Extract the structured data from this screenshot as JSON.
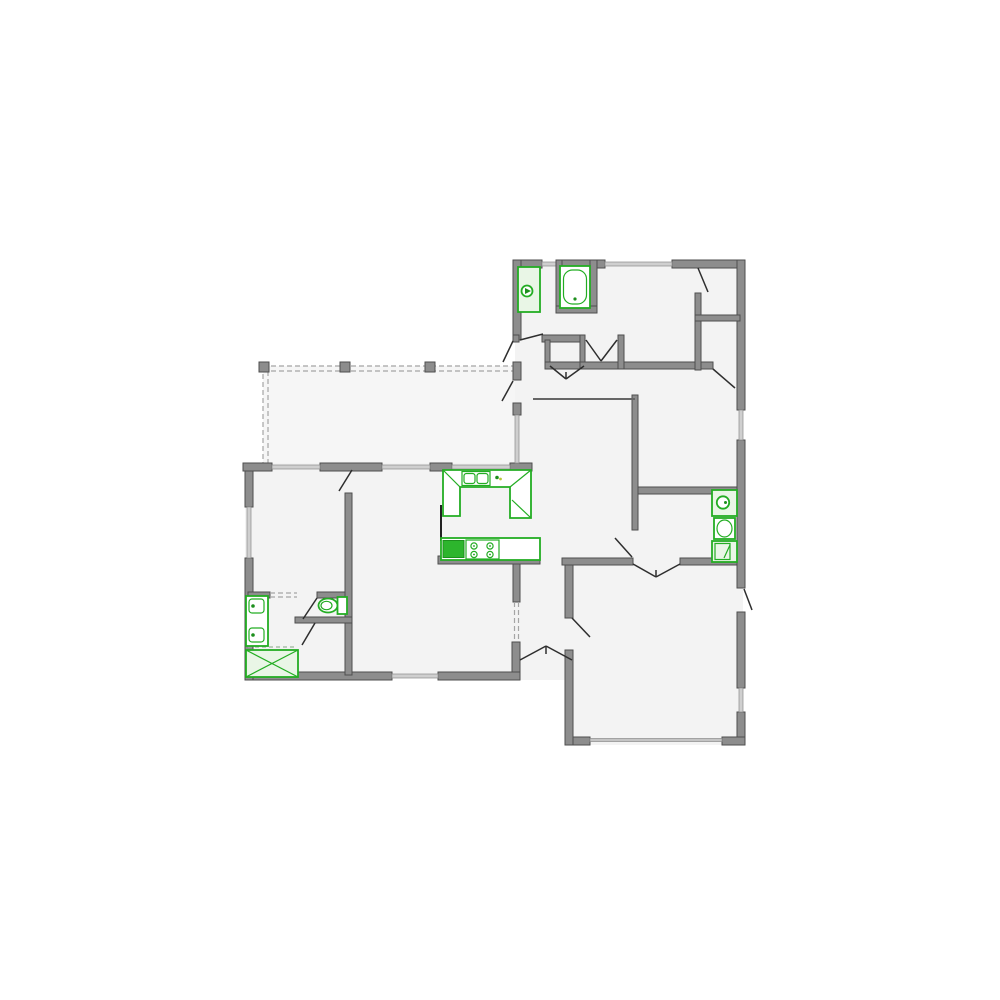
{
  "diagram": {
    "type": "floor-plan",
    "description": "Single-story residential floor plan, top-down architectural line drawing with gray walls and green plumbing/kitchen fixtures",
    "text_labels": []
  },
  "colors": {
    "background": "#ffffff",
    "floor": "#f3f3f3",
    "patio_floor": "#f6f6f6",
    "wall": "#8d8d8d",
    "wall_outline": "#4e4e4e",
    "window": "#cfcfcf",
    "fixture_green": "#23ad23",
    "fixture_fill_pale": "#e9f6e6",
    "fixture_fill_solid": "#2db52d",
    "door_leaf": "#2e2e2e",
    "dashed_line": "#a5a5a5"
  },
  "fixtures": [
    {
      "name": "bathtub",
      "area": "top-bathroom"
    },
    {
      "name": "toilet-stall",
      "area": "top-bathroom"
    },
    {
      "name": "kitchen-u-counter",
      "area": "kitchen"
    },
    {
      "name": "double-sink",
      "area": "kitchen"
    },
    {
      "name": "refrigerator",
      "area": "kitchen"
    },
    {
      "name": "range-cooktop",
      "area": "kitchen"
    },
    {
      "name": "toilet",
      "area": "right-bathroom"
    },
    {
      "name": "lavatory-sink",
      "area": "right-bathroom"
    },
    {
      "name": "washer-cabinet",
      "area": "right-bathroom"
    },
    {
      "name": "double-vanity",
      "area": "left-bathroom"
    },
    {
      "name": "toilet",
      "area": "left-bathroom"
    },
    {
      "name": "shower",
      "area": "left-bathroom"
    }
  ],
  "features": [
    "dashed covered-patio outline with posts",
    "garage with wide garage-door opening at bottom",
    "angled double entry door",
    "door swing leaves",
    "windows shown as light gray wall gaps"
  ]
}
